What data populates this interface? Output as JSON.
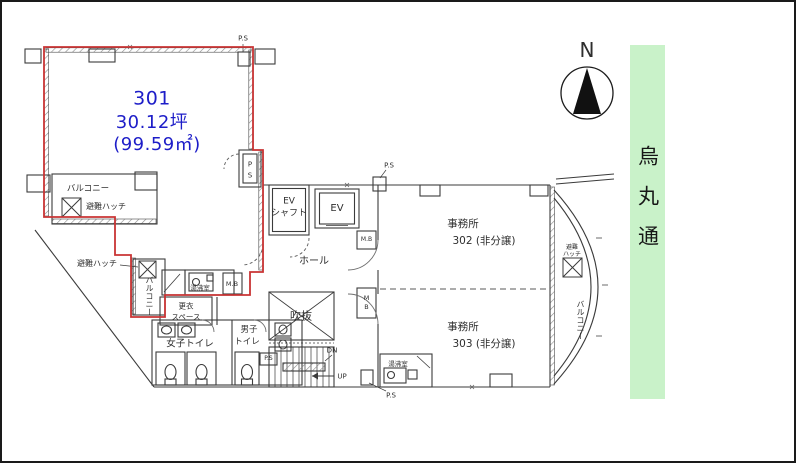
{
  "unit301": {
    "number": "301",
    "area_tsubo": "30.12坪",
    "area_m2": "(99.59㎡)"
  },
  "labels": {
    "ps": "P.S",
    "ps_p": "P",
    "ps_s": "S",
    "mb": "M.B",
    "mb_m": "M",
    "mb_b": "B",
    "balcony": "バルコニー",
    "escape_hatch": "避難ハッチ",
    "escape_hatch_l1": "避難",
    "escape_hatch_l2": "ハッチ",
    "hot_water_room": "湯沸室",
    "changing_l1": "更衣",
    "changing_l2": "スペース",
    "women_toilet": "女子トイレ",
    "men_toilet_l1": "男子",
    "men_toilet_l2": "トイレ",
    "atrium": "吹抜",
    "hall": "ホール",
    "ev": "EV",
    "ev_shaft_l1": "EV",
    "ev_shaft_l2": "シャフト",
    "dn": "DN",
    "up": "UP",
    "office": "事務所",
    "office302_num": "302 (非分譲)",
    "office303_num": "303 (非分譲)"
  },
  "street": {
    "name": "烏丸通"
  },
  "compass": {
    "north": "N"
  },
  "colors": {
    "unit_text": "#1d1dc8",
    "demise_line": "#c93434",
    "street_bg": "#c9f2c9"
  }
}
